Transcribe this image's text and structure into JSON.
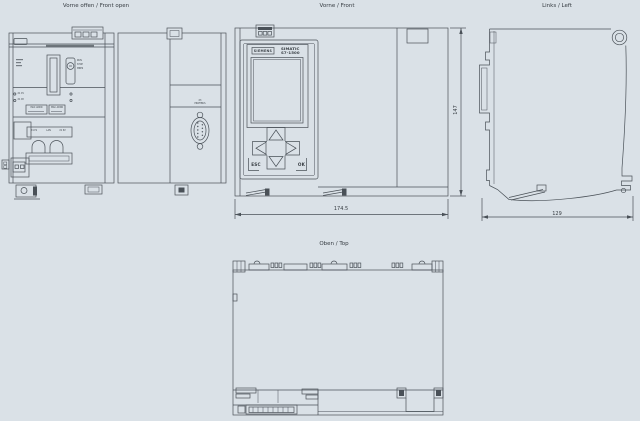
{
  "colors": {
    "bg": "#dae1e7",
    "line": "#4a5158",
    "text": "#353b41",
    "screen": "#dee5ea"
  },
  "views": {
    "front_open": {
      "title": "Vorne offen / Front open",
      "mode_switch_labels": [
        "RUN",
        "STOP",
        "MRES"
      ],
      "led_labels": [
        "X1 P1",
        "X1 P2"
      ],
      "mac_labels": [
        "MAC ADDR",
        "MAC ADDR"
      ],
      "port_labels": [
        "X1 P1",
        "LAN",
        "X1 P2"
      ],
      "dsub_label_line1": "X3",
      "dsub_label_line2": "PROFIBUS"
    },
    "front": {
      "title": "Vorne / Front",
      "brand": "SIEMENS",
      "product_line1": "SIMATIC",
      "product_line2": "S7-1500",
      "esc_label": "ESC",
      "ok_label": "OK",
      "width_dim": "174.5",
      "height_dim": "147"
    },
    "left": {
      "title": "Links / Left",
      "depth_dim": "129"
    },
    "top": {
      "title": "Oben / Top"
    }
  }
}
